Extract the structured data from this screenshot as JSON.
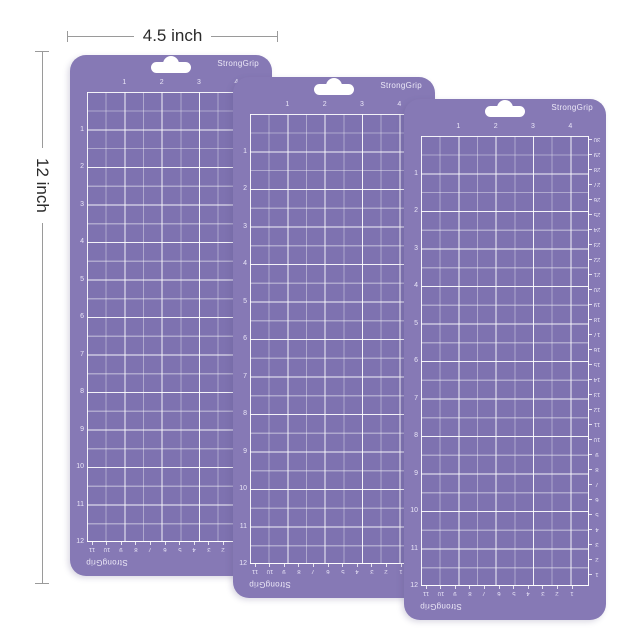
{
  "page": {
    "background": "#ffffff"
  },
  "annotations": {
    "width": {
      "label": "4.5 inch"
    },
    "height": {
      "label": "12 inch"
    }
  },
  "mat": {
    "brand_top": "StrongGrip",
    "brand_bottom": "StrongGrip",
    "ruler_top_inches": [
      "1",
      "2",
      "3",
      "4"
    ],
    "ruler_left_inches": [
      "1",
      "2",
      "3",
      "4",
      "5",
      "6",
      "7",
      "8",
      "9",
      "10",
      "11",
      "12"
    ],
    "ruler_bottom_cm": [
      "11",
      "10",
      "9",
      "8",
      "7",
      "6",
      "5",
      "4",
      "3",
      "2",
      "1"
    ],
    "ruler_right_cm": [
      "30",
      "29",
      "28",
      "27",
      "26",
      "25",
      "24",
      "23",
      "22",
      "21",
      "20",
      "19",
      "18",
      "17",
      "16",
      "15",
      "14",
      "13",
      "12",
      "11",
      "10",
      "9",
      "8",
      "7",
      "6",
      "5",
      "4",
      "3",
      "2",
      "1"
    ]
  },
  "mats": [
    {
      "name": "cutting-mat-1"
    },
    {
      "name": "cutting-mat-2"
    },
    {
      "name": "cutting-mat-3"
    }
  ],
  "colors": {
    "mat-body": "#8679b5",
    "mat-grid": "#7e72b0",
    "grid-line": "#ffffff",
    "mat-text": "#ece8f7",
    "dim-line": "#9a9a9a",
    "dim-text": "#2b2b2b"
  }
}
